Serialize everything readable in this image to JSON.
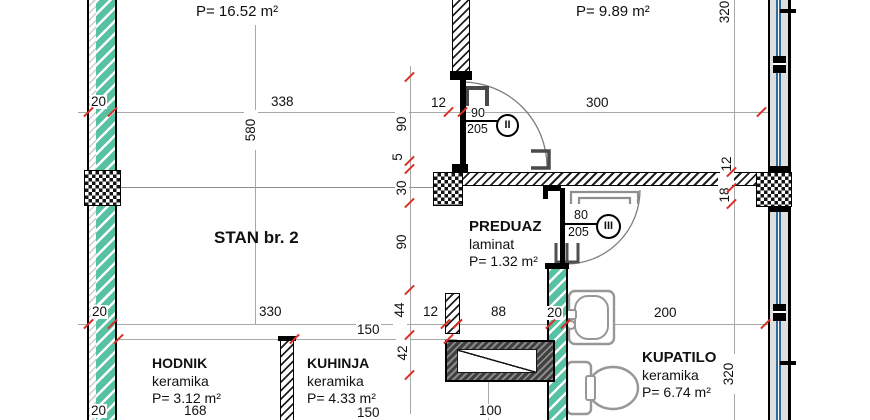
{
  "drawing": {
    "apartment_label": "STAN br. 2",
    "rooms": {
      "room_top_left": {
        "area": "P= 16.52 m²"
      },
      "room_top_right": {
        "area": "P= 9.89 m²"
      },
      "preduaz": {
        "name": "PREDUAZ",
        "floor": "laminat",
        "area": "P= 1.32 m²"
      },
      "hodnik": {
        "name": "HODNIK",
        "floor": "keramika",
        "area": "P= 3.12 m²"
      },
      "kuhinja": {
        "name": "KUHINJA",
        "floor": "keramika",
        "area": "P= 4.33 m²"
      },
      "kupatilo": {
        "name": "KUPATILO",
        "floor": "keramika",
        "area": "P= 6.74 m²"
      }
    },
    "doors": {
      "door_2": {
        "width": "90",
        "height": "205",
        "mark": "II"
      },
      "door_3": {
        "width": "80",
        "height": "205",
        "mark": "III"
      }
    },
    "dimensions": {
      "top_line": {
        "wall_20": "20",
        "span_338": "338",
        "part_12": "12",
        "span_300": "300"
      },
      "mid_line": {
        "wall_20": "20",
        "span_330": "330",
        "d12": "12",
        "d88": "88",
        "d20": "20",
        "d200": "200",
        "d150": "150"
      },
      "bottom_line": {
        "wall_20": "20",
        "d168": "168",
        "d150": "150",
        "d100": "100"
      },
      "left_chain": {
        "d580": "580",
        "d90a": "90",
        "d5": "5",
        "d30": "30",
        "d90b": "90",
        "d44": "44",
        "d42": "42"
      },
      "right_chain": {
        "d320_top": "320",
        "d12": "12",
        "d18": "18",
        "d320_kupatilo": "320"
      }
    },
    "colors": {
      "wall_hatch_teal": "#57c1a3",
      "window_glass_blue": "#2f6b9d",
      "dim_tick_red": "#d93025"
    }
  }
}
